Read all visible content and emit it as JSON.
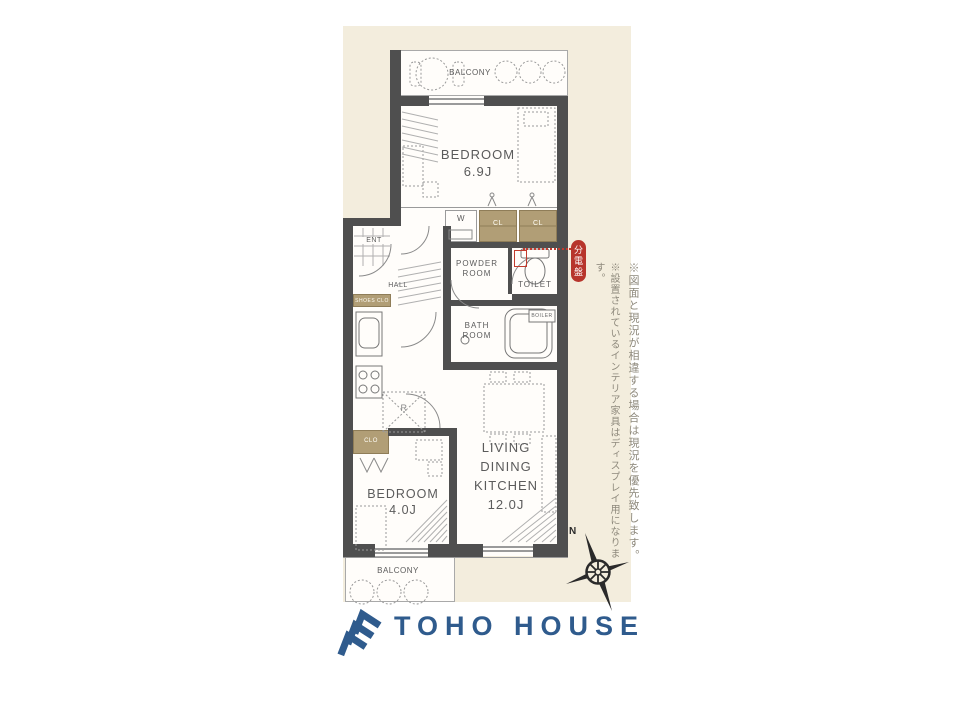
{
  "floorplan": {
    "balcony_top_label": "BALCONY",
    "balcony_bottom_label": "BALCONY",
    "bedroom1": {
      "name": "BEDROOM",
      "size": "6.9J"
    },
    "bedroom2": {
      "name": "BEDROOM",
      "size": "4.0J"
    },
    "ldk": {
      "line1": "LIVING",
      "line2": "DINING",
      "line3": "KITCHEN",
      "size": "12.0J"
    },
    "powder_room": {
      "line1": "POWDER",
      "line2": "ROOM"
    },
    "bath_room": {
      "line1": "BATH",
      "line2": "ROOM"
    },
    "toilet_label": "TOILET",
    "hall_label": "HALL",
    "ent_label": "ENT",
    "closet_w_label": "W",
    "closet_cl1_label": "CL",
    "closet_cl2_label": "CL",
    "shoes_closet_label": "SHOES CLO",
    "closet_clo_label": "CLO",
    "fridge_label": "R",
    "boiler_label": "BOILER",
    "breaker_badge": "分電盤"
  },
  "annotations": {
    "note1": "※図面と現況が相違する場合は現況を優先致します。",
    "note2": "※設置されているインテリア家具はディスプレイ用になります。"
  },
  "compass": {
    "north_label": "N"
  },
  "logo": {
    "brand": "TOHO HOUSE"
  },
  "colors": {
    "panel_bg": "#f3eddd",
    "wall": "#4f4f4f",
    "closet_tan": "#b19e76",
    "accent_red": "#c23b2e",
    "logo_blue": "#2f5b8d",
    "note_text": "#8e897c"
  }
}
